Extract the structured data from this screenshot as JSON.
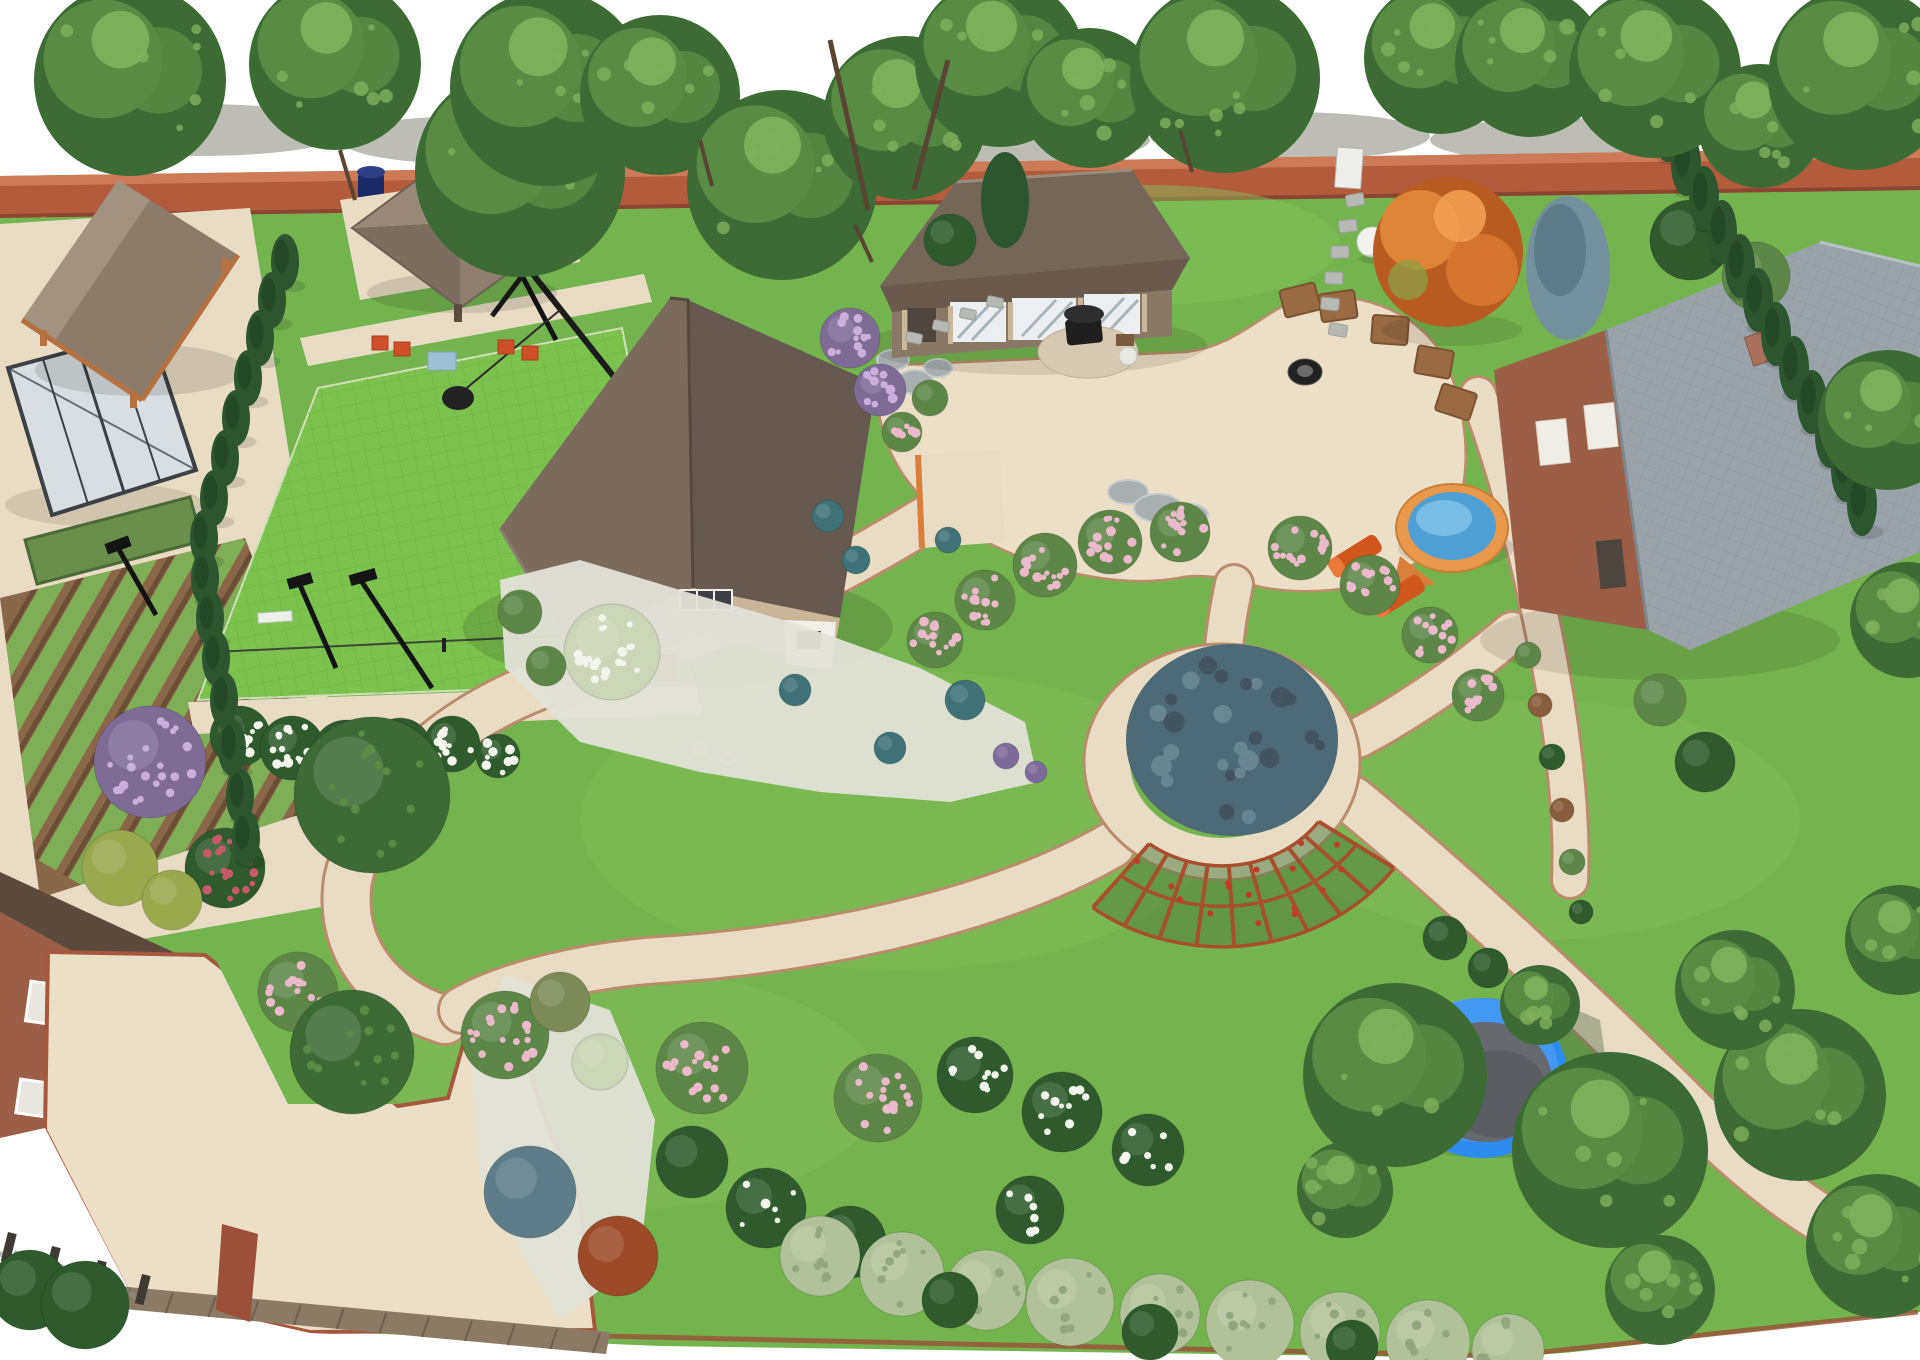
{
  "meta": {
    "title": "Aerial 3D landscape design rendering of a large backyard",
    "description": "Bird's-eye 3D render: brick boundary fence with tree row, wooden gazebo, greenhouse, vegetable beds, fenced sports lawn with floodlights and swing, two-storey main house, guest house with barbecue patio, fire pit with timber seats, circular ring path with large blue-green shrub, arc pergola, round hot-tub pool with loungers, trampoline, brick house with grey roof, curved sand-coloured paths, flower borders and hedges."
  },
  "palette": {
    "bg": "#ffffff",
    "shadowTop": "#b6b6ae",
    "brick": "#b25c3c",
    "brickLight": "#cd7b57",
    "brickDark": "#8c4530",
    "brickWall": "#9c5f45",
    "lawn": "#74b44e",
    "lawnLight": "#86c35c",
    "court": "#7cc24f",
    "courtLine": "#63ad3e",
    "path": "#e9dcc4",
    "pathEdge": "#b98d6a",
    "patio": "#ecdfc8",
    "soil": "#8a6847",
    "soilDark": "#6b4f34",
    "crop": "#7fae56",
    "glass": "#d9dee2",
    "frame": "#3c4146",
    "roofTan": "#8b7b6b",
    "roofTanLight": "#a29281",
    "roofTanDark": "#75665a",
    "roofBrown": "#7b6b5d",
    "roofBrownDark": "#665950",
    "roofGray": "#9aa3a9",
    "roofGrayDark": "#8a949b",
    "wood": "#b5713f",
    "woodDark": "#8a5330",
    "wallBeige": "#c9b698",
    "wallWhite": "#f1efe8",
    "treeDark": "#3c6b34",
    "treeMid": "#578c42",
    "treeLight": "#7fb25c",
    "conifer": "#2c5530",
    "coniferDark": "#1f4023",
    "spruce": "#73909c",
    "spruceDark": "#56737f",
    "bushDark": "#2e5a2d",
    "bushMid": "#5e8747",
    "bushOlive": "#7c8a55",
    "bushYellow": "#9aa84e",
    "bushBlue": "#5f7d88",
    "bushRed": "#9c4a28",
    "bushBrown": "#8a5d3a",
    "sage": "#b2c298",
    "sageDark": "#93a77c",
    "paleTree": "#ccd6b8",
    "teal": "#3f7276",
    "lilacBase": "#7e6b96",
    "lilac": "#c9aede",
    "flowerWhite": "#f4f4ee",
    "flowerPink": "#eab9cc",
    "roseRed": "#c75a6a",
    "purpleShrub": "#7d6a9a",
    "pergola": "#a84f2c",
    "pergolaGreen": "#4e7a3c",
    "water": "#4f9fd4",
    "waterLight": "#83c4ea",
    "poolRim": "#e8984a",
    "poolDeck": "#d8803c",
    "trampRing": "#2e8bf0",
    "trampRingLight": "#5aa6f5",
    "trampMat": "#65686d",
    "trampNet": "#3d5a3a",
    "lounger": "#d2571e",
    "loungerLight": "#e8793a",
    "black": "#1f1f1f",
    "stone": "#a9aeb0",
    "stoneLight": "#c6cbcd",
    "deck": "#8a7a66",
    "deckDark": "#6e6052",
    "white": "#f2f2ef",
    "gravel": "#e3e2d8",
    "barrel": "#1b2a66",
    "ringShrub": "#4e6a76"
  },
  "scene": {
    "top_shadows": [
      [
        200,
        130,
        150,
        26
      ],
      [
        470,
        140,
        130,
        24
      ],
      [
        740,
        134,
        150,
        26
      ],
      [
        1010,
        140,
        140,
        24
      ],
      [
        1290,
        136,
        140,
        24
      ],
      [
        1560,
        140,
        130,
        22
      ],
      [
        1810,
        132,
        120,
        22
      ]
    ],
    "canopies": [
      [
        130,
        80,
        96
      ],
      [
        335,
        64,
        86
      ],
      [
        520,
        172,
        105
      ],
      [
        548,
        88,
        98
      ],
      [
        660,
        95,
        80
      ],
      [
        782,
        185,
        95
      ],
      [
        905,
        118,
        82
      ],
      [
        1000,
        62,
        85
      ],
      [
        1090,
        98,
        70
      ],
      [
        1225,
        78,
        95
      ],
      [
        1440,
        58,
        76
      ],
      [
        1530,
        62,
        75
      ],
      [
        1655,
        72,
        86
      ],
      [
        1760,
        126,
        62
      ],
      [
        1860,
        78,
        92
      ]
    ],
    "lawn_trees": [
      [
        1395,
        1075,
        92
      ],
      [
        1610,
        1150,
        98
      ],
      [
        1800,
        1095,
        86
      ],
      [
        1878,
        1246,
        72
      ],
      [
        1735,
        990,
        60
      ],
      [
        1900,
        940,
        55
      ],
      [
        1888,
        420,
        70
      ],
      [
        1908,
        620,
        58
      ],
      [
        1345,
        1190,
        48
      ],
      [
        1660,
        1290,
        55
      ],
      [
        1540,
        1005,
        40
      ]
    ],
    "conifers_left": [
      [
        285,
        262
      ],
      [
        272,
        300
      ],
      [
        260,
        338
      ],
      [
        248,
        378
      ],
      [
        236,
        418
      ],
      [
        225,
        458
      ],
      [
        214,
        498
      ],
      [
        204,
        538
      ],
      [
        205,
        578
      ],
      [
        210,
        618
      ],
      [
        216,
        658
      ],
      [
        224,
        700
      ],
      [
        232,
        748
      ],
      [
        240,
        796
      ],
      [
        246,
        838
      ]
    ],
    "conifers_right": [
      [
        1668,
        130
      ],
      [
        1686,
        164
      ],
      [
        1704,
        198
      ],
      [
        1722,
        232
      ],
      [
        1740,
        266
      ],
      [
        1758,
        300
      ],
      [
        1776,
        334
      ],
      [
        1794,
        368
      ],
      [
        1812,
        402
      ],
      [
        1830,
        436
      ],
      [
        1846,
        470
      ],
      [
        1862,
        504
      ]
    ],
    "bushes": [
      [
        240,
        736,
        30,
        "bushDark",
        "flowerWhite",
        16
      ],
      [
        292,
        748,
        32,
        "bushDark",
        "flowerWhite",
        16
      ],
      [
        346,
        754,
        34,
        "bushDark",
        "flowerWhite",
        16
      ],
      [
        400,
        750,
        32,
        "bushDark",
        "flowerWhite",
        14
      ],
      [
        452,
        744,
        28,
        "bushDark",
        "flowerWhite",
        12
      ],
      [
        498,
        756,
        22,
        "bushDark",
        "flowerWhite",
        8
      ],
      [
        150,
        762,
        56,
        "lilacBase",
        "lilac",
        22
      ],
      [
        225,
        868,
        40,
        "bushDark",
        "roseRed",
        18
      ],
      [
        120,
        868,
        38,
        "bushYellow",
        "",
        0
      ],
      [
        172,
        900,
        30,
        "bushYellow",
        "",
        0
      ],
      [
        372,
        795,
        78,
        "treeDark",
        "treeMid",
        14
      ],
      [
        612,
        652,
        48,
        "paleTree",
        "flowerWhite",
        20
      ],
      [
        828,
        516,
        16,
        "teal",
        "",
        0
      ],
      [
        856,
        560,
        14,
        "teal",
        "",
        0
      ],
      [
        965,
        700,
        20,
        "teal",
        "",
        0
      ],
      [
        890,
        748,
        16,
        "teal",
        "",
        0
      ],
      [
        795,
        690,
        16,
        "teal",
        "",
        0
      ],
      [
        948,
        540,
        13,
        "teal",
        "",
        0
      ],
      [
        1006,
        756,
        13,
        "purpleShrub",
        "",
        0
      ],
      [
        1036,
        772,
        11,
        "purpleShrub",
        "",
        0
      ],
      [
        520,
        612,
        22,
        "bushMid",
        "",
        0
      ],
      [
        546,
        666,
        20,
        "bushMid",
        "",
        0
      ],
      [
        850,
        338,
        30,
        "lilacBase",
        "lilac",
        12
      ],
      [
        880,
        390,
        26,
        "lilacBase",
        "lilac",
        10
      ],
      [
        902,
        432,
        20,
        "bushMid",
        "flowerPink",
        8
      ],
      [
        930,
        398,
        18,
        "bushMid",
        "",
        0
      ],
      [
        935,
        640,
        28,
        "bushMid",
        "flowerPink",
        12
      ],
      [
        985,
        600,
        30,
        "bushMid",
        "flowerPink",
        12
      ],
      [
        1045,
        565,
        32,
        "bushMid",
        "flowerPink",
        14
      ],
      [
        1110,
        542,
        32,
        "bushMid",
        "flowerPink",
        14
      ],
      [
        1180,
        532,
        30,
        "bushMid",
        "flowerPink",
        12
      ],
      [
        1300,
        548,
        32,
        "bushMid",
        "flowerPink",
        14
      ],
      [
        1370,
        585,
        30,
        "bushMid",
        "flowerPink",
        12
      ],
      [
        1430,
        635,
        28,
        "bushMid",
        "flowerPink",
        12
      ],
      [
        1478,
        695,
        26,
        "bushMid",
        "flowerPink",
        10
      ],
      [
        505,
        1035,
        44,
        "bushMid",
        "flowerPink",
        18
      ],
      [
        702,
        1068,
        46,
        "bushMid",
        "flowerPink",
        18
      ],
      [
        878,
        1098,
        44,
        "bushMid",
        "flowerPink",
        16
      ],
      [
        975,
        1075,
        38,
        "bushDark",
        "flowerWhite",
        10
      ],
      [
        1062,
        1112,
        40,
        "bushDark",
        "flowerWhite",
        10
      ],
      [
        1148,
        1150,
        36,
        "bushDark",
        "flowerWhite",
        8
      ],
      [
        560,
        1002,
        30,
        "bushOlive",
        "",
        0
      ],
      [
        600,
        1062,
        28,
        "paleTree",
        "",
        0
      ],
      [
        530,
        1192,
        46,
        "bushBlue",
        "",
        0
      ],
      [
        618,
        1256,
        40,
        "bushRed",
        "",
        0
      ],
      [
        692,
        1162,
        36,
        "bushDark",
        "",
        0
      ],
      [
        766,
        1208,
        40,
        "bushDark",
        "flowerWhite",
        6
      ],
      [
        850,
        1242,
        36,
        "bushDark",
        "",
        0
      ],
      [
        820,
        1256,
        40,
        "sage",
        "sageDark",
        8
      ],
      [
        902,
        1274,
        42,
        "sage",
        "sageDark",
        8
      ],
      [
        986,
        1290,
        40,
        "sage",
        "sageDark",
        8
      ],
      [
        1070,
        1302,
        44,
        "sage",
        "sageDark",
        8
      ],
      [
        1160,
        1314,
        40,
        "sage",
        "sageDark",
        8
      ],
      [
        1250,
        1324,
        44,
        "sage",
        "sageDark",
        8
      ],
      [
        1340,
        1332,
        40,
        "sage",
        "sageDark",
        8
      ],
      [
        1428,
        1342,
        42,
        "sage",
        "sageDark",
        8
      ],
      [
        1508,
        1350,
        36,
        "sage",
        "sageDark",
        6
      ],
      [
        950,
        1300,
        28,
        "bushDark",
        "",
        0
      ],
      [
        1150,
        1332,
        28,
        "bushDark",
        "",
        0
      ],
      [
        1352,
        1346,
        26,
        "bushDark",
        "",
        0
      ],
      [
        298,
        992,
        40,
        "bushMid",
        "flowerPink",
        16
      ],
      [
        352,
        1052,
        62,
        "treeDark",
        "treeMid",
        12
      ],
      [
        1445,
        938,
        22,
        "bushDark",
        "",
        0
      ],
      [
        1488,
        968,
        20,
        "bushDark",
        "",
        0
      ],
      [
        1690,
        240,
        40,
        "bushDark",
        "",
        0
      ],
      [
        1756,
        276,
        34,
        "bushMid",
        "",
        0
      ],
      [
        1705,
        762,
        30,
        "bushDark",
        "",
        0
      ],
      [
        1660,
        700,
        26,
        "bushMid",
        "",
        0
      ],
      [
        1528,
        655,
        13,
        "bushMid",
        "",
        0
      ],
      [
        1540,
        705,
        12,
        "bushBrown",
        "",
        0
      ],
      [
        1552,
        757,
        13,
        "bushDark",
        "",
        0
      ],
      [
        1562,
        810,
        12,
        "bushBrown",
        "",
        0
      ],
      [
        1572,
        862,
        13,
        "bushMid",
        "",
        0
      ],
      [
        1581,
        912,
        12,
        "bushDark",
        "",
        0
      ],
      [
        950,
        240,
        26,
        "bushDark",
        "",
        0
      ],
      [
        1030,
        1210,
        34,
        "bushDark",
        "flowerWhite",
        6
      ],
      [
        30,
        1290,
        40,
        "bushDark",
        "",
        0
      ],
      [
        85,
        1305,
        44,
        "bushDark",
        "",
        0
      ]
    ],
    "rocks": [
      [
        893,
        360,
        16,
        10
      ],
      [
        915,
        382,
        18,
        12
      ],
      [
        938,
        368,
        14,
        9
      ],
      [
        1128,
        492,
        20,
        12
      ],
      [
        1158,
        508,
        24,
        14
      ],
      [
        1190,
        515,
        18,
        11
      ],
      [
        700,
        748,
        9,
        6
      ],
      [
        728,
        758,
        8,
        5
      ]
    ],
    "seats": [
      [
        1338,
        306,
        -8
      ],
      [
        1390,
        330,
        4
      ],
      [
        1434,
        362,
        10
      ],
      [
        1456,
        402,
        18
      ],
      [
        1300,
        300,
        -14
      ]
    ],
    "stones_gate": [
      [
        1355,
        200,
        -10
      ],
      [
        1348,
        226,
        -6
      ],
      [
        1340,
        252,
        -2
      ],
      [
        1334,
        278,
        2
      ],
      [
        1330,
        304,
        6
      ],
      [
        1338,
        330,
        10
      ]
    ],
    "stones_guesthouse": [
      [
        995,
        302,
        12
      ],
      [
        968,
        314,
        12
      ],
      [
        941,
        326,
        12
      ],
      [
        914,
        338,
        12
      ]
    ],
    "pergola": {
      "cx": 1222,
      "cy": 762,
      "r1": 118,
      "r2": 210,
      "a1": 35,
      "a2": 128,
      "spokes": 9,
      "dots": 16
    },
    "ring_dots": 26,
    "veg": {
      "clip": [
        [
          0,
          598
        ],
        [
          245,
          538
        ],
        [
          345,
          800
        ],
        [
          40,
          898
        ]
      ],
      "origin": [
        172,
        718
      ],
      "rot": 120,
      "rows": 11,
      "len": 380,
      "step": 34
    }
  }
}
